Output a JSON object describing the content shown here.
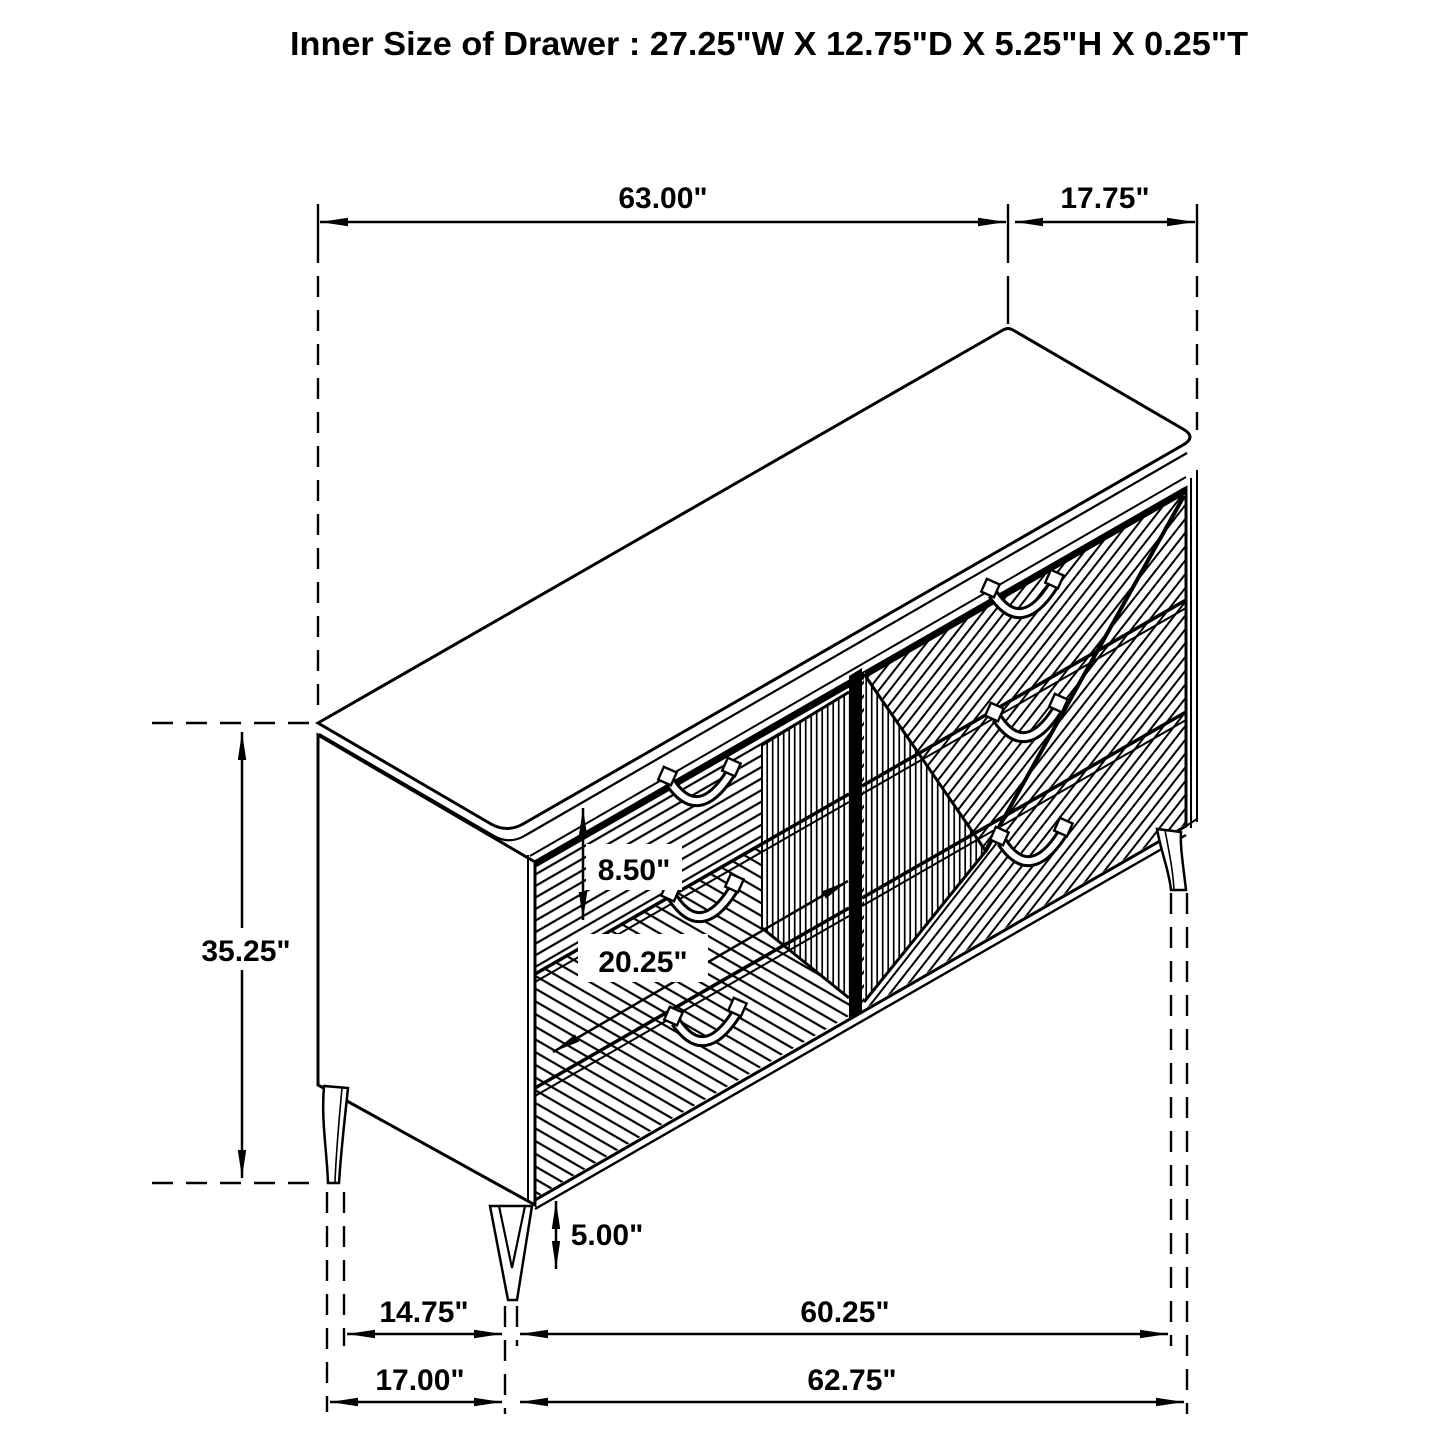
{
  "title": "Inner Size of Drawer : 27.25\"W X 12.75\"D X 5.25\"H X 0.25\"T",
  "dimensions": {
    "top_width": "63.00\"",
    "top_depth": "17.75\"",
    "overall_height": "35.25\"",
    "drawer_face_height": "8.50\"",
    "drawer_face_width": "20.25\"",
    "floor_clearance": "5.00\"",
    "leg_inset_depth": "14.75\"",
    "leg_span_width": "60.25\"",
    "base_depth": "17.00\"",
    "base_width": "62.75\""
  }
}
